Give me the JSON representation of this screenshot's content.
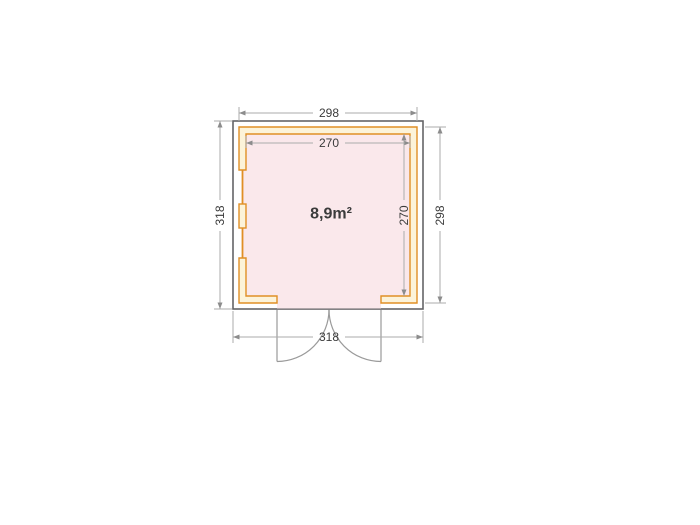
{
  "diagram": {
    "type": "shed-floor-plan",
    "area_label": "8,9m²",
    "dimensions": {
      "top_outer": "298",
      "top_inner": "270",
      "left_overall": "318",
      "right_inner": "270",
      "right_wall": "298",
      "bottom_overall": "318"
    },
    "colors": {
      "wall_stroke": "#E08F25",
      "wall_fill": "#FCF3D9",
      "interior_fill": "#FAE8EB",
      "frame_stroke": "#646467",
      "dim_line": "#ABABAB",
      "dim_arrow": "#8C8C8C",
      "dim_text": "#3B3B3B",
      "door_stroke": "#9A9A9A",
      "background": "#FFFFFF"
    }
  }
}
